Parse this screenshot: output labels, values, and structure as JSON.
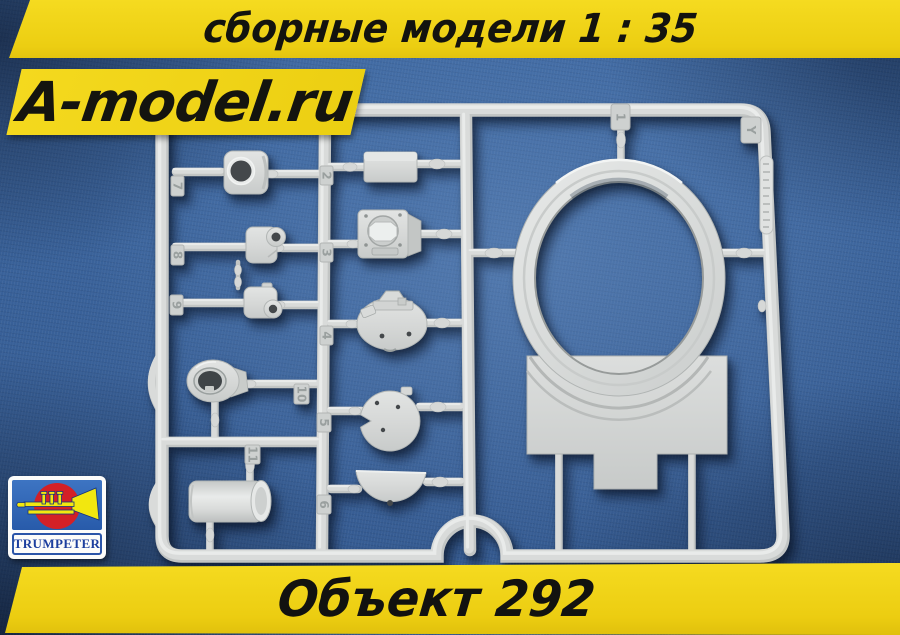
{
  "top_banner": {
    "text": "сборные модели 1 : 35"
  },
  "site_logo": {
    "text": "A-model.ru"
  },
  "bottom_banner": {
    "text": "Объект 292"
  },
  "manufacturer_logo": {
    "brand": "TRUMPETER"
  },
  "colors": {
    "banner_yellow": "#f0d418",
    "banner_text_black": "#13130f",
    "fabric_blue": "#3a639c",
    "plastic_grey": "#d6d8d7",
    "trumpeter_blue": "#2e66b8",
    "trumpeter_red": "#d32026",
    "trumpeter_yellow": "#f2e70f",
    "trumpeter_text_blue": "#1d3f9e"
  },
  "photo": {
    "subject": "grey plastic model sprue on blue denim fabric",
    "sprue": {
      "letter_tag": "Y",
      "part_tags": [
        "1",
        "2",
        "3",
        "4",
        "5",
        "6",
        "7",
        "8",
        "9",
        "10",
        "11"
      ]
    }
  }
}
